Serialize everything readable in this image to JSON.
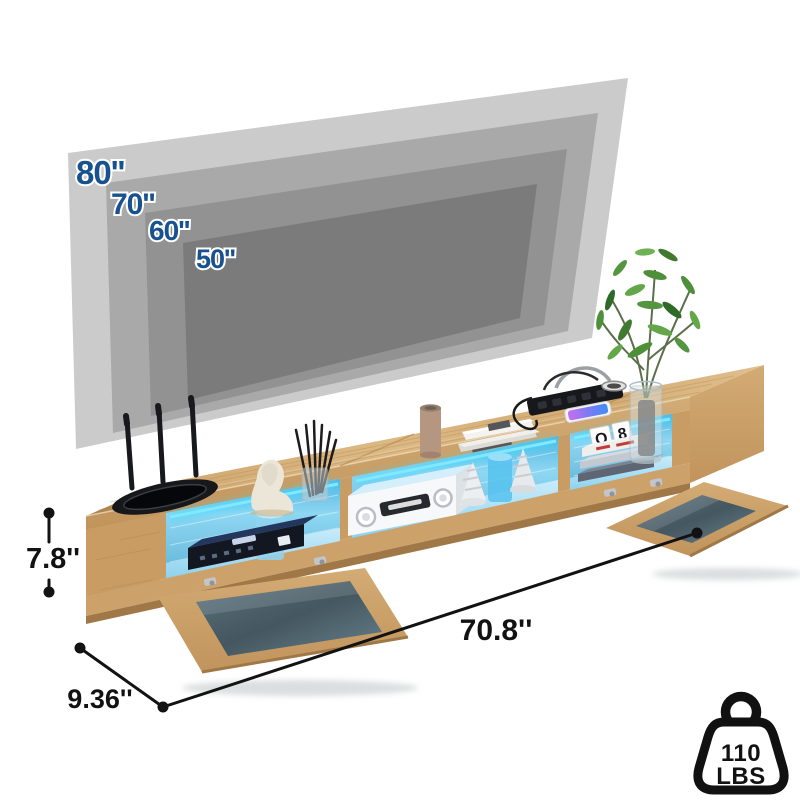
{
  "tv_size_chart": {
    "label_color": "#17518e",
    "sizes": [
      {
        "label": "80''",
        "color": "#cbcbcb"
      },
      {
        "label": "70''",
        "color": "#a9a9a9"
      },
      {
        "label": "60''",
        "color": "#929292"
      },
      {
        "label": "50''",
        "color": "#7b7b7b"
      }
    ]
  },
  "dimensions": {
    "height_label": "7.8''",
    "depth_label": "9.36''",
    "width_label": "70.8''",
    "line_color": "#121212"
  },
  "weight_capacity": {
    "value": "110",
    "unit": "LBS"
  },
  "stand": {
    "letter_blocks": [
      "Q",
      "8"
    ],
    "wood_color": "#cfa772",
    "led_color": "#3fd9ff"
  }
}
